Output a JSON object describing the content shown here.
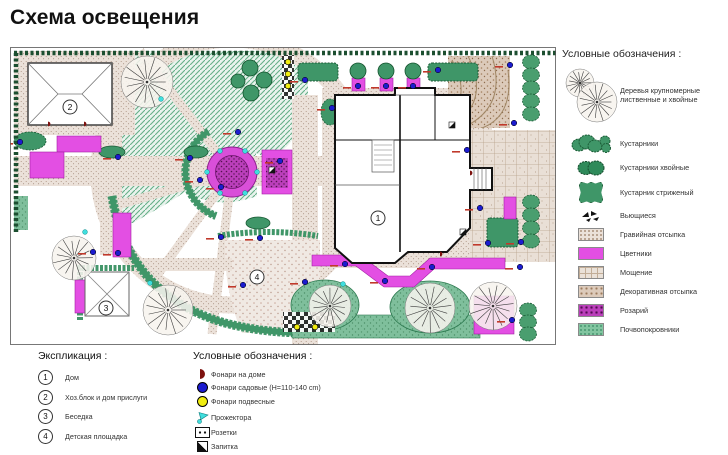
{
  "title": "Схема освещения",
  "planting_legend": {
    "header": "Условные обозначения  :",
    "items": [
      {
        "icon": "large-tree",
        "label": "Деревья крупномерные лиственные и хвойные"
      },
      {
        "icon": "shrubs",
        "label": "Кустарники"
      },
      {
        "icon": "conifer-shrubs",
        "label": "Кустарники хвойные"
      },
      {
        "icon": "trimmed-shrub",
        "label": "Кустарник стриженый"
      },
      {
        "icon": "climbers",
        "label": "Вьющиеся"
      },
      {
        "icon": "gravel-fill",
        "label": "Гравийная отсыпка"
      },
      {
        "icon": "flower-beds",
        "label": "Цветники"
      },
      {
        "icon": "paving",
        "label": "Мощение"
      },
      {
        "icon": "decorative-fill",
        "label": "Декоративная отсыпка"
      },
      {
        "icon": "rosary",
        "label": "Розарий"
      },
      {
        "icon": "ground-cover",
        "label": "Почвопокровники"
      }
    ]
  },
  "explication": {
    "header": "Экспликация :",
    "items": [
      {
        "num": "1",
        "label": "Дом"
      },
      {
        "num": "2",
        "label": "Хоз.блок и дом прислуги"
      },
      {
        "num": "3",
        "label": "Беседка"
      },
      {
        "num": "4",
        "label": "Детская площадка"
      }
    ]
  },
  "lighting_legend": {
    "header": "Условные обозначения  :",
    "items": [
      {
        "icon": "house-lamp",
        "label": "Фонари на доме"
      },
      {
        "icon": "garden-lamp",
        "label": "Фонари садовые  (H=110-140 cm)"
      },
      {
        "icon": "pendant-lamp",
        "label": "Фонари подвесные"
      },
      {
        "icon": "floodlight",
        "label": "Прожектора"
      },
      {
        "icon": "socket",
        "label": "Розетки"
      },
      {
        "icon": "power-feed",
        "label": "Запитка"
      }
    ]
  },
  "colors": {
    "flower_bed": "#e34fe3",
    "hedge": "#3f9668",
    "lamp_garden": "#1c1ccf",
    "lamp_pendant": "#f0ed10",
    "floodlight": "#3fdede",
    "house_lamp": "#7d120f",
    "rosary": "#bb3fbb",
    "lamp_label_red": "#c0392b"
  },
  "plan": {
    "building_labels": [
      {
        "num": "1",
        "x": 378,
        "y": 218
      },
      {
        "num": "2",
        "x": 70,
        "y": 107
      },
      {
        "num": "3",
        "x": 106,
        "y": 308
      },
      {
        "num": "4",
        "x": 257,
        "y": 277
      }
    ],
    "markers": {
      "garden": [
        [
          20,
          142
        ],
        [
          118,
          157
        ],
        [
          190,
          158
        ],
        [
          200,
          180
        ],
        [
          221,
          187
        ],
        [
          238,
          132
        ],
        [
          280,
          161
        ],
        [
          305,
          80
        ],
        [
          332,
          108
        ],
        [
          358,
          86
        ],
        [
          386,
          86
        ],
        [
          413,
          86
        ],
        [
          438,
          70
        ],
        [
          467,
          150
        ],
        [
          510,
          65
        ],
        [
          514,
          123
        ],
        [
          480,
          208
        ],
        [
          488,
          243
        ],
        [
          521,
          242
        ],
        [
          512,
          320
        ],
        [
          345,
          264
        ],
        [
          385,
          281
        ],
        [
          432,
          267
        ],
        [
          305,
          282
        ],
        [
          520,
          267
        ],
        [
          93,
          252
        ],
        [
          118,
          253
        ],
        [
          221,
          237
        ],
        [
          260,
          238
        ],
        [
          243,
          285
        ]
      ],
      "pendant": [
        [
          288,
          62
        ],
        [
          288,
          74
        ],
        [
          288,
          86
        ],
        [
          297,
          327
        ],
        [
          315,
          327
        ]
      ],
      "flood": [
        [
          257,
          172
        ],
        [
          245,
          193
        ],
        [
          220,
          193
        ],
        [
          207,
          172
        ],
        [
          220,
          151
        ],
        [
          245,
          151
        ],
        [
          161,
          99
        ],
        [
          85,
          232
        ],
        [
          150,
          283
        ],
        [
          343,
          284
        ]
      ],
      "house": [
        [
          48,
          124
        ],
        [
          84,
          124
        ],
        [
          470,
          173
        ],
        [
          440,
          254
        ]
      ],
      "power": [
        [
          272,
          170
        ],
        [
          452,
          125
        ],
        [
          463,
          232
        ]
      ]
    },
    "trees": [
      [
        147,
        82,
        26
      ],
      [
        74,
        258,
        22
      ],
      [
        168,
        310,
        25
      ],
      [
        330,
        306,
        21
      ],
      [
        430,
        308,
        25
      ],
      [
        493,
        306,
        24
      ]
    ],
    "green_trees": [
      [
        250,
        68,
        8
      ],
      [
        264,
        80,
        8
      ],
      [
        251,
        93,
        8
      ],
      [
        238,
        81,
        7
      ],
      [
        358,
        71,
        8
      ],
      [
        386,
        71,
        8
      ],
      [
        413,
        71,
        8
      ]
    ],
    "hedge_scallops": [
      {
        "x": 531,
        "y": 62,
        "n": 5,
        "s": 13
      },
      {
        "x": 531,
        "y": 202,
        "n": 4,
        "s": 13
      },
      {
        "x": 528,
        "y": 310,
        "n": 3,
        "s": 12
      }
    ],
    "legend_tree_parts": [
      [
        18,
        17,
        14
      ],
      [
        35,
        36,
        20
      ]
    ]
  }
}
